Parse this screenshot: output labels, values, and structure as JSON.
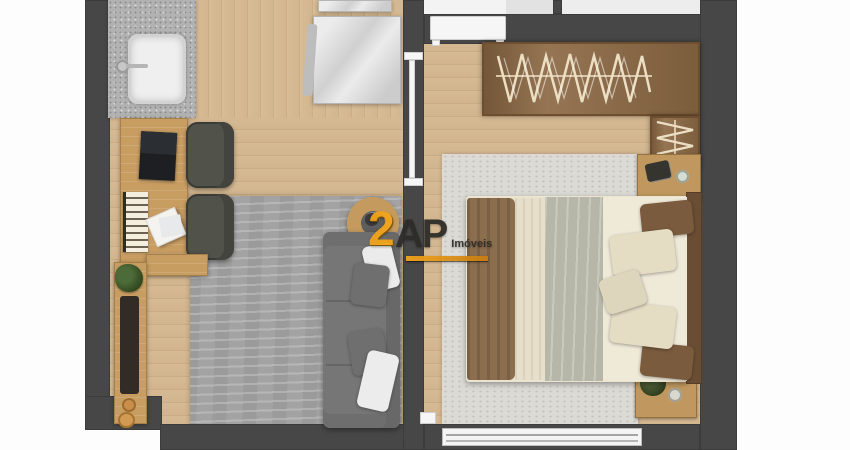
{
  "watermark": {
    "number": "2",
    "letters": "AP",
    "name": "Imóveis"
  },
  "palette": {
    "wall": "#474747",
    "wood_floor": "#d2b58e",
    "living_rug": "#a3a3a3",
    "bedroom_rug": "#dbdad5",
    "sofa": "#767676",
    "desk_wood": "#c89d62",
    "wardrobe": "#8c6944",
    "bed_sheet": "#efe9d8",
    "bed_blanket": "#b7b7a9",
    "bed_throw": "#8b6e4e",
    "watermark_orange": "#f2a41c",
    "watermark_dark": "#2d2c29"
  },
  "floorplan": {
    "type": "apartment-top-view-render",
    "rooms": [
      {
        "id": "living-kitchen",
        "furniture": [
          "kitchen-counter",
          "kitchen-sink",
          "faucet",
          "dining-table",
          "desk",
          "laptop",
          "midi-keyboard",
          "papers",
          "office-chair",
          "office-chair",
          "bench",
          "console-table",
          "plant",
          "decor-bowls",
          "area-rug",
          "sofa",
          "white-pillow",
          "gray-pillow",
          "round-side-table"
        ]
      },
      {
        "id": "bedroom",
        "furniture": [
          "wardrobe",
          "hanging-clothes",
          "shelf-clothes",
          "double-bed",
          "headboard",
          "blanket",
          "throw",
          "pillows",
          "nightstand",
          "nightstand",
          "plant",
          "glass",
          "area-rug",
          "window"
        ]
      }
    ],
    "structure": [
      "exterior-walls",
      "partition-wall",
      "bedroom-door",
      "pocket-door",
      "window"
    ]
  }
}
